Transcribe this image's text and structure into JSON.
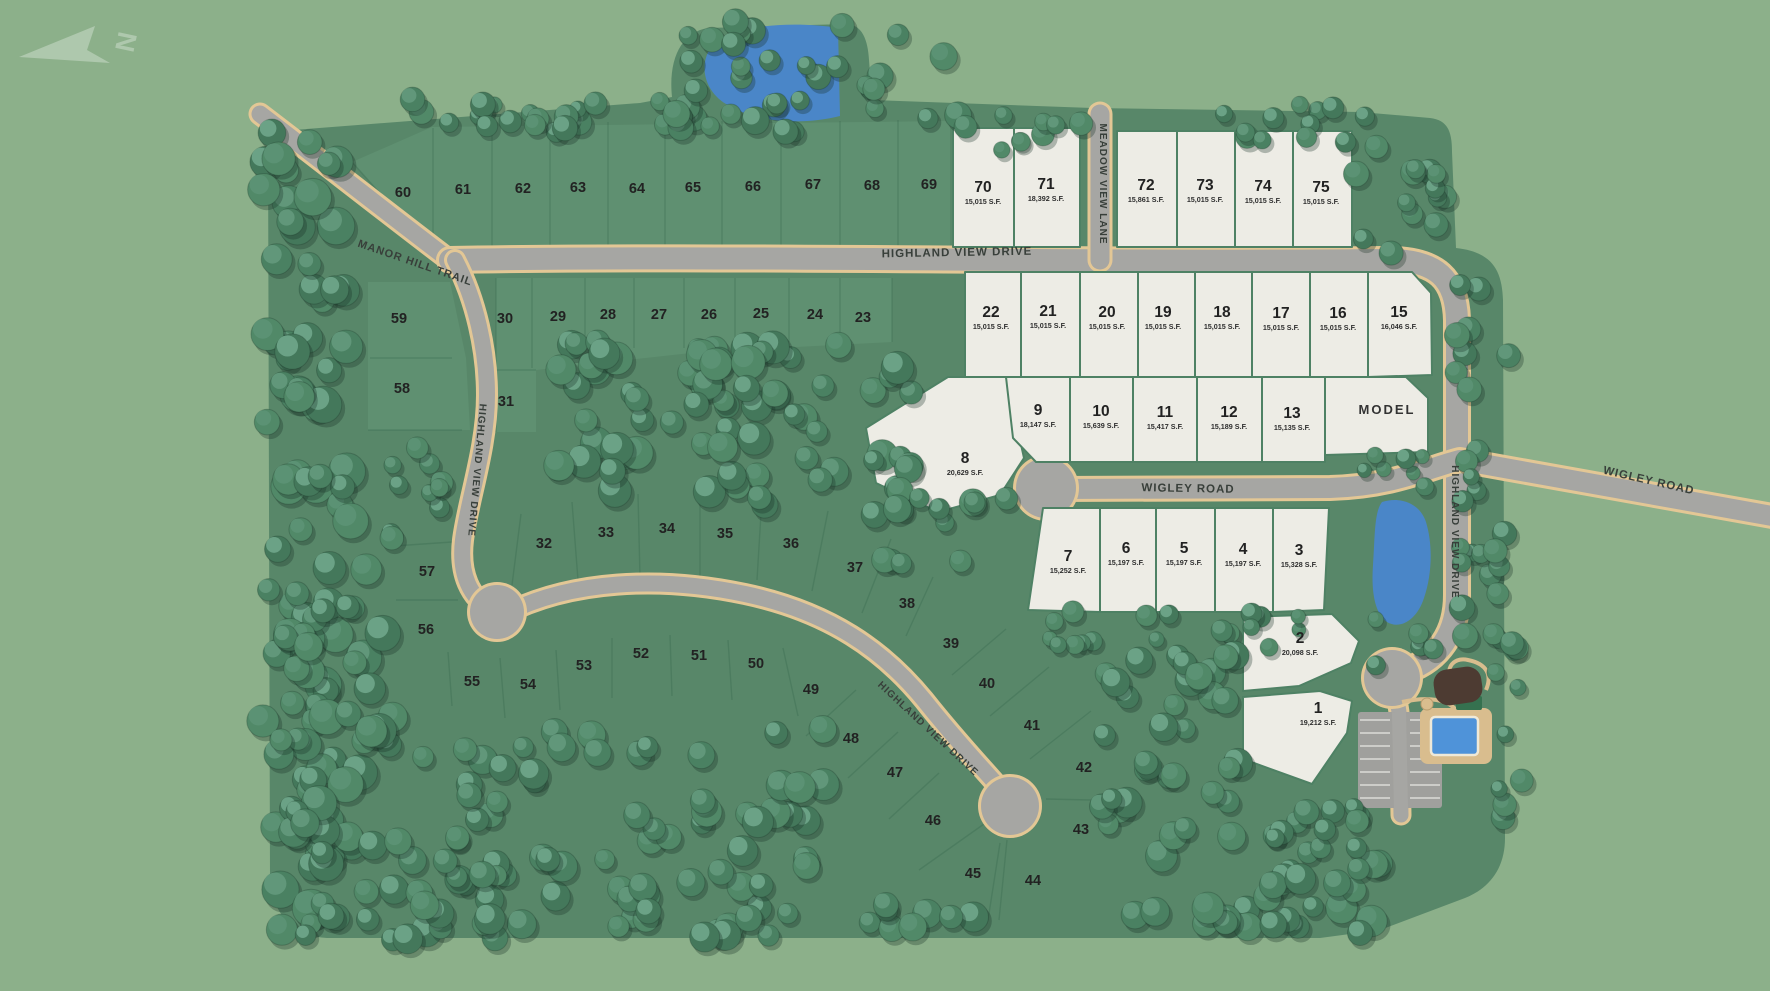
{
  "map": {
    "type": "residential-site-plan",
    "compass": {
      "letter": "N"
    },
    "colors": {
      "background": "#8cb08a",
      "parcel": "#588769",
      "lot_strip": "#5f9071",
      "available_lot": "#edece5",
      "lot_border": "#4e8164",
      "road": "#a6a6a3",
      "road_edge": "#e3c795",
      "water": "#4a86c8",
      "pool": "#4f93d9",
      "deck": "#d9bd8e",
      "building": "#4d3b32",
      "label_text": "#222222",
      "road_text": "#383f3a"
    },
    "road_labels": [
      {
        "text": "MANOR HILL TRAIL",
        "x": 414,
        "y": 266,
        "rot": 19,
        "fs": 11
      },
      {
        "text": "HIGHLAND VIEW DRIVE",
        "x": 957,
        "y": 256,
        "rot": -1,
        "fs": 11.5
      },
      {
        "text": "MEADOW VIEW LANE",
        "x": 1100,
        "y": 184,
        "rot": 90,
        "fs": 10
      },
      {
        "text": "HIGHLAND VIEW DRIVE",
        "x": 474,
        "y": 470,
        "rot": 95,
        "fs": 10
      },
      {
        "text": "HIGHLAND VIEW DRIVE",
        "x": 926,
        "y": 731,
        "rot": 43,
        "fs": 10
      },
      {
        "text": "WIGLEY ROAD",
        "x": 1188,
        "y": 492,
        "rot": 1,
        "fs": 11.5
      },
      {
        "text": "WIGLEY ROAD",
        "x": 1648,
        "y": 484,
        "rot": 13,
        "fs": 11.5
      },
      {
        "text": "HIGHLAND VIEW DRIVE",
        "x": 1452,
        "y": 532,
        "rot": 90,
        "fs": 10
      }
    ],
    "lots": [
      {
        "n": "1",
        "sqft": "19,212 S.F.",
        "status": "available",
        "x": 1318,
        "y": 708
      },
      {
        "n": "2",
        "sqft": "20,098 S.F.",
        "status": "available",
        "x": 1300,
        "y": 638
      },
      {
        "n": "3",
        "sqft": "15,328 S.F.",
        "status": "available",
        "x": 1299,
        "y": 550
      },
      {
        "n": "4",
        "sqft": "15,197 S.F.",
        "status": "available",
        "x": 1243,
        "y": 549
      },
      {
        "n": "5",
        "sqft": "15,197 S.F.",
        "status": "available",
        "x": 1184,
        "y": 548
      },
      {
        "n": "6",
        "sqft": "15,197 S.F.",
        "status": "available",
        "x": 1126,
        "y": 548
      },
      {
        "n": "7",
        "sqft": "15,252 S.F.",
        "status": "available",
        "x": 1068,
        "y": 556
      },
      {
        "n": "8",
        "sqft": "20,629 S.F.",
        "status": "available",
        "x": 965,
        "y": 458
      },
      {
        "n": "9",
        "sqft": "18,147 S.F.",
        "status": "available",
        "x": 1038,
        "y": 410
      },
      {
        "n": "10",
        "sqft": "15,639 S.F.",
        "status": "available",
        "x": 1101,
        "y": 411
      },
      {
        "n": "11",
        "sqft": "15,417 S.F.",
        "status": "available",
        "x": 1165,
        "y": 412
      },
      {
        "n": "12",
        "sqft": "15,189 S.F.",
        "status": "available",
        "x": 1229,
        "y": 412
      },
      {
        "n": "13",
        "sqft": "15,135 S.F.",
        "status": "available",
        "x": 1292,
        "y": 413
      },
      {
        "n": "MODEL",
        "sqft": null,
        "status": "model",
        "x": 1387,
        "y": 409
      },
      {
        "n": "15",
        "sqft": "16,046 S.F.",
        "status": "available",
        "x": 1399,
        "y": 312
      },
      {
        "n": "16",
        "sqft": "15,015 S.F.",
        "status": "available",
        "x": 1338,
        "y": 313
      },
      {
        "n": "17",
        "sqft": "15,015 S.F.",
        "status": "available",
        "x": 1281,
        "y": 313
      },
      {
        "n": "18",
        "sqft": "15,015 S.F.",
        "status": "available",
        "x": 1222,
        "y": 312
      },
      {
        "n": "19",
        "sqft": "15,015 S.F.",
        "status": "available",
        "x": 1163,
        "y": 312
      },
      {
        "n": "20",
        "sqft": "15,015 S.F.",
        "status": "available",
        "x": 1107,
        "y": 312
      },
      {
        "n": "21",
        "sqft": "15,015 S.F.",
        "status": "available",
        "x": 1048,
        "y": 311
      },
      {
        "n": "22",
        "sqft": "15,015 S.F.",
        "status": "available",
        "x": 991,
        "y": 312
      },
      {
        "n": "70",
        "sqft": "15,015 S.F.",
        "status": "available",
        "x": 983,
        "y": 187
      },
      {
        "n": "71",
        "sqft": "18,392 S.F.",
        "status": "available",
        "x": 1046,
        "y": 184
      },
      {
        "n": "72",
        "sqft": "15,861 S.F.",
        "status": "available",
        "x": 1146,
        "y": 185
      },
      {
        "n": "73",
        "sqft": "15,015 S.F.",
        "status": "available",
        "x": 1205,
        "y": 185
      },
      {
        "n": "74",
        "sqft": "15,015 S.F.",
        "status": "available",
        "x": 1263,
        "y": 186
      },
      {
        "n": "75",
        "sqft": "15,015 S.F.",
        "status": "available",
        "x": 1321,
        "y": 187
      },
      {
        "n": "23",
        "status": "sold",
        "x": 863,
        "y": 317
      },
      {
        "n": "24",
        "status": "sold",
        "x": 815,
        "y": 314
      },
      {
        "n": "25",
        "status": "sold",
        "x": 761,
        "y": 313
      },
      {
        "n": "26",
        "status": "sold",
        "x": 709,
        "y": 314
      },
      {
        "n": "27",
        "status": "sold",
        "x": 659,
        "y": 314
      },
      {
        "n": "28",
        "status": "sold",
        "x": 608,
        "y": 314
      },
      {
        "n": "29",
        "status": "sold",
        "x": 558,
        "y": 316
      },
      {
        "n": "30",
        "status": "sold",
        "x": 505,
        "y": 318
      },
      {
        "n": "31",
        "status": "sold",
        "x": 506,
        "y": 401
      },
      {
        "n": "32",
        "status": "sold",
        "x": 544,
        "y": 543
      },
      {
        "n": "33",
        "status": "sold",
        "x": 606,
        "y": 532
      },
      {
        "n": "34",
        "status": "sold",
        "x": 667,
        "y": 528
      },
      {
        "n": "35",
        "status": "sold",
        "x": 725,
        "y": 533
      },
      {
        "n": "36",
        "status": "sold",
        "x": 791,
        "y": 543
      },
      {
        "n": "37",
        "status": "sold",
        "x": 855,
        "y": 567
      },
      {
        "n": "38",
        "status": "sold",
        "x": 907,
        "y": 603
      },
      {
        "n": "39",
        "status": "sold",
        "x": 951,
        "y": 643
      },
      {
        "n": "40",
        "status": "sold",
        "x": 987,
        "y": 683
      },
      {
        "n": "41",
        "status": "sold",
        "x": 1032,
        "y": 725
      },
      {
        "n": "42",
        "status": "sold",
        "x": 1084,
        "y": 767
      },
      {
        "n": "43",
        "status": "sold",
        "x": 1081,
        "y": 829
      },
      {
        "n": "44",
        "status": "sold",
        "x": 1033,
        "y": 880
      },
      {
        "n": "45",
        "status": "sold",
        "x": 973,
        "y": 873
      },
      {
        "n": "46",
        "status": "sold",
        "x": 933,
        "y": 820
      },
      {
        "n": "47",
        "status": "sold",
        "x": 895,
        "y": 772
      },
      {
        "n": "48",
        "status": "sold",
        "x": 851,
        "y": 738
      },
      {
        "n": "49",
        "status": "sold",
        "x": 811,
        "y": 689
      },
      {
        "n": "50",
        "status": "sold",
        "x": 756,
        "y": 663
      },
      {
        "n": "51",
        "status": "sold",
        "x": 699,
        "y": 655
      },
      {
        "n": "52",
        "status": "sold",
        "x": 641,
        "y": 653
      },
      {
        "n": "53",
        "status": "sold",
        "x": 584,
        "y": 665
      },
      {
        "n": "54",
        "status": "sold",
        "x": 528,
        "y": 684
      },
      {
        "n": "55",
        "status": "sold",
        "x": 472,
        "y": 681
      },
      {
        "n": "56",
        "status": "sold",
        "x": 426,
        "y": 629
      },
      {
        "n": "57",
        "status": "sold",
        "x": 427,
        "y": 571
      },
      {
        "n": "58",
        "status": "sold",
        "x": 402,
        "y": 388
      },
      {
        "n": "59",
        "status": "sold",
        "x": 399,
        "y": 318
      },
      {
        "n": "60",
        "status": "sold",
        "x": 403,
        "y": 192
      },
      {
        "n": "61",
        "status": "sold",
        "x": 463,
        "y": 189
      },
      {
        "n": "62",
        "status": "sold",
        "x": 523,
        "y": 188
      },
      {
        "n": "63",
        "status": "sold",
        "x": 578,
        "y": 187
      },
      {
        "n": "64",
        "status": "sold",
        "x": 637,
        "y": 188
      },
      {
        "n": "65",
        "status": "sold",
        "x": 693,
        "y": 187
      },
      {
        "n": "66",
        "status": "sold",
        "x": 753,
        "y": 186
      },
      {
        "n": "67",
        "status": "sold",
        "x": 813,
        "y": 184
      },
      {
        "n": "68",
        "status": "sold",
        "x": 872,
        "y": 185
      },
      {
        "n": "69",
        "status": "sold",
        "x": 929,
        "y": 184
      }
    ]
  }
}
